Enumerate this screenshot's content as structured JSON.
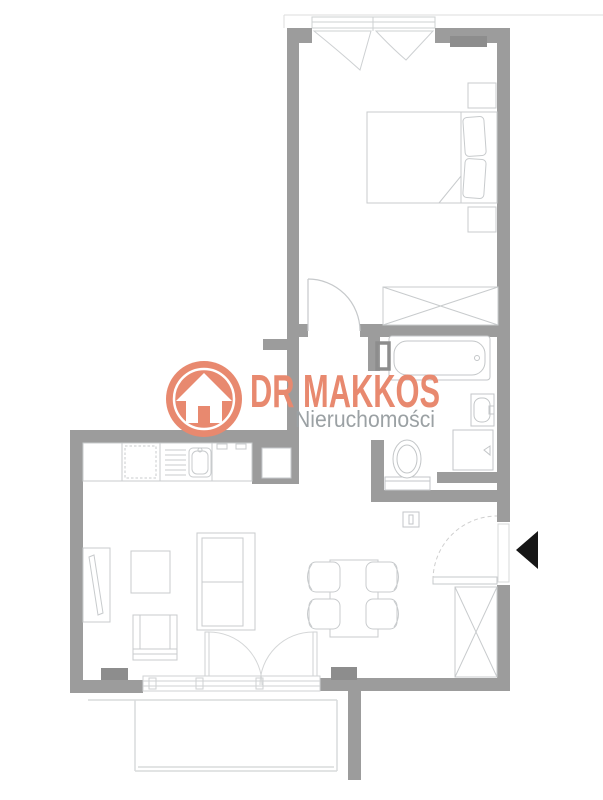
{
  "brand": {
    "name": "DR MAKKOS",
    "subtitle": "Nieruchomości",
    "accent_color": "#e8896f",
    "subtitle_color": "#9ba1a4",
    "logo_icon": "house-arrow-icon"
  },
  "floorplan": {
    "wall_color": "#9c9c9c",
    "radiator_color": "#8d8d8d",
    "furniture_line_color": "#c8cbcd",
    "fixture_line_color": "#c3c6c8",
    "balcony_line_color": "#d9dbdc",
    "entrance_arrow_color": "#161616",
    "entrance_arrow": "left-pointing-triangle",
    "fixtures": [
      "window",
      "bed",
      "pillow",
      "nightstand",
      "wardrobe",
      "bedroom-door",
      "bathtub",
      "towel-radiator",
      "washbasin",
      "washing-machine",
      "toilet",
      "kitchen-counter",
      "kitchen-sink",
      "fridge",
      "cooktop",
      "ventilation-shaft",
      "sofa",
      "coffee-table",
      "armchair",
      "tv-unit",
      "dining-table",
      "dining-chair",
      "balcony",
      "balcony-door",
      "entrance-door",
      "entry-wardrobe",
      "radiator",
      "entrance-arrow"
    ]
  }
}
